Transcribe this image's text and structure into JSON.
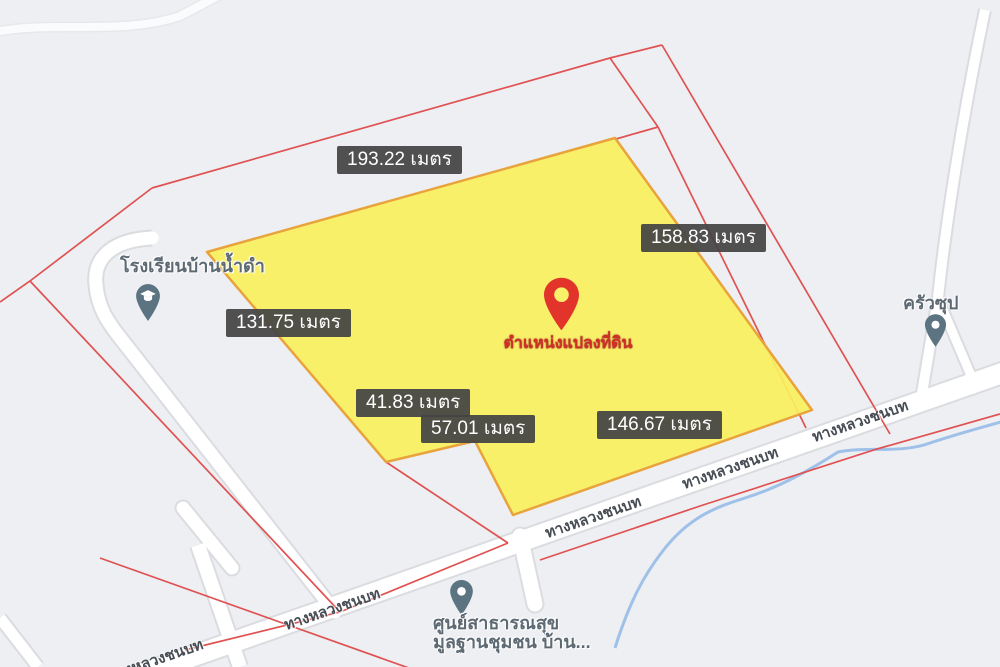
{
  "map": {
    "background_color": "#EDEFF3",
    "plot": {
      "fill_color": "#FAF05E",
      "border_color": "#E8A33D",
      "marker_label": "ตำแหน่งแปลงที่ดิน",
      "marker_color": "#E3342C",
      "measurements": [
        {
          "text": "193.22 เมตร",
          "side": "top"
        },
        {
          "text": "158.83 เมตร",
          "side": "right"
        },
        {
          "text": "131.75 เมตร",
          "side": "left"
        },
        {
          "text": "41.83 เมตร",
          "side": "bottom-left"
        },
        {
          "text": "57.01 เมตร",
          "side": "bottom-notch"
        },
        {
          "text": "146.67 เมตร",
          "side": "bottom-right"
        }
      ]
    },
    "road_name": "ทางหลวงชนบท",
    "pois": [
      {
        "id": "school",
        "label": "โรงเรียนบ้านน้ำดำ",
        "icon": "school-pin-icon",
        "pin_color": "#5C7482"
      },
      {
        "id": "restaurant",
        "label": "ครัวซุป",
        "icon": "restaurant-pin-icon",
        "pin_color": "#5C7482"
      },
      {
        "id": "health-center",
        "label_line1": "ศูนย์สาธารณสุข",
        "label_line2": "มูลฐานชุมชน บ้าน...",
        "icon": "health-pin-icon",
        "pin_color": "#5C7482"
      }
    ],
    "colors": {
      "parcel_line": "#E05252",
      "road_fill": "#FFFFFF",
      "road_casing": "#DADCE0",
      "stream": "#9FC0E8",
      "chip_bg": "#444444",
      "chip_text": "#FFFFFF",
      "road_text": "#474D54",
      "poi_text": "#5E6A73"
    }
  }
}
